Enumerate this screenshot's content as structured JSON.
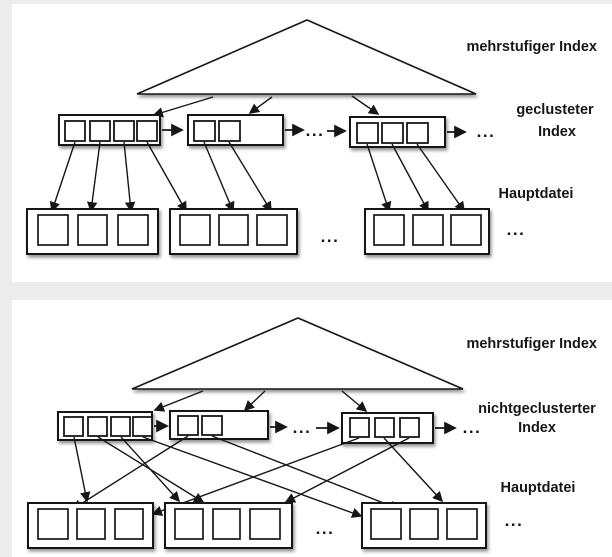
{
  "page": {
    "background": "#ececec",
    "panel_color": "#ffffff",
    "line_color": "#161616"
  },
  "ellipsis": "...",
  "diagrams": [
    {
      "id": "clustered",
      "labels": {
        "top_level_index": "mehrstufiger Index",
        "index_type_line1": "geclusteter",
        "index_type_line2": "Index",
        "main_file": "Hauptdatei"
      },
      "index_blocks": [
        {
          "entries": 4
        },
        {
          "entries": 2
        },
        {
          "entries": 3
        }
      ],
      "data_blocks": [
        {
          "records": 3
        },
        {
          "records": 3
        },
        {
          "records": 3
        }
      ],
      "links": [
        {
          "from": "index1.e1",
          "to": "file1.r1"
        },
        {
          "from": "index1.e2",
          "to": "file1.r2"
        },
        {
          "from": "index1.e3",
          "to": "file1.r3"
        },
        {
          "from": "index1.e4",
          "to": "file2.r1"
        },
        {
          "from": "index2.e1",
          "to": "file2.r2"
        },
        {
          "from": "index2.e2",
          "to": "file2.r3"
        },
        {
          "from": "index3.e1",
          "to": "file3.r1"
        },
        {
          "from": "index3.e2",
          "to": "file3.r2"
        },
        {
          "from": "index3.e3",
          "to": "file3.r3"
        }
      ]
    },
    {
      "id": "nonclustered",
      "labels": {
        "top_level_index": "mehrstufiger Index",
        "index_type_line1": "nichtgeclusterter",
        "index_type_line2": "Index",
        "main_file": "Hauptdatei"
      },
      "index_blocks": [
        {
          "entries": 4
        },
        {
          "entries": 2
        },
        {
          "entries": 3
        }
      ],
      "data_blocks": [
        {
          "records": 3
        },
        {
          "records": 3
        },
        {
          "records": 3
        }
      ],
      "links": [
        {
          "from": "index1.e1",
          "to": "file1.r2"
        },
        {
          "from": "index1.e2",
          "to": "file2.r2"
        },
        {
          "from": "index1.e3",
          "to": "file2.r1"
        },
        {
          "from": "index1.e4",
          "to": "file3.r1"
        },
        {
          "from": "index2.e1",
          "to": "file1.r1"
        },
        {
          "from": "index2.e2",
          "to": "file3.r2"
        },
        {
          "from": "index3.e1",
          "to": "file1.r3"
        },
        {
          "from": "index3.e2",
          "to": "file3.r3"
        },
        {
          "from": "index3.e3",
          "to": "file2.r3"
        }
      ]
    }
  ]
}
